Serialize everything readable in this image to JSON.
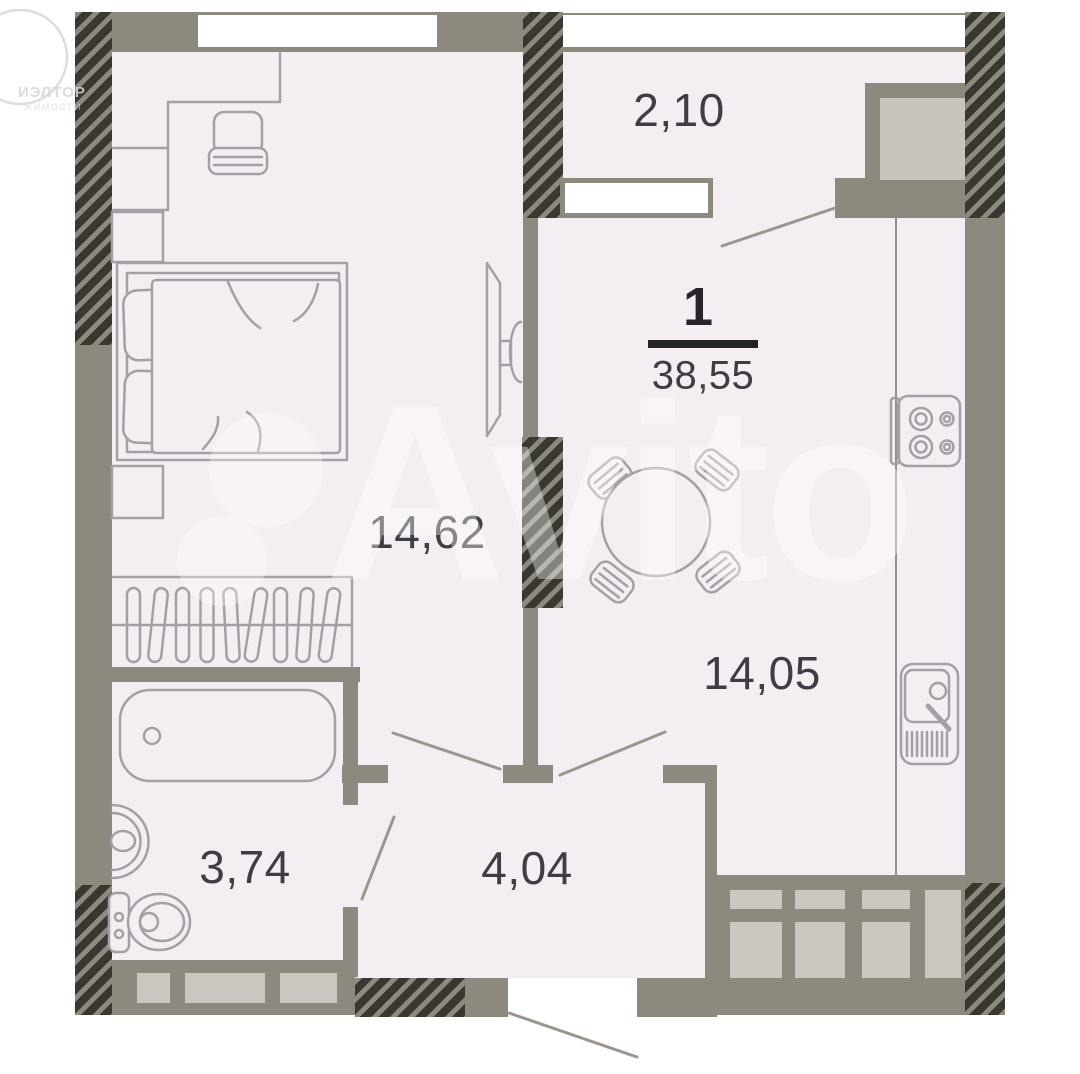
{
  "floorplan": {
    "summary": {
      "rooms_count": "1",
      "total_area": "38,55"
    },
    "rooms": [
      {
        "id": "balcony",
        "area": "2,10"
      },
      {
        "id": "bedroom",
        "area": "14,62"
      },
      {
        "id": "kitchen-living",
        "area": "14,05"
      },
      {
        "id": "bathroom",
        "area": "3,74"
      },
      {
        "id": "hallway",
        "area": "4,04"
      }
    ],
    "watermarks": {
      "portal": "Avito",
      "agency_line1": "ИЭЛТОР",
      "agency_line2": "ЖИМОСТИ"
    },
    "colors": {
      "wall": "#8d897f",
      "hatch": "#393830",
      "floor": "#f4eef3",
      "panel": "#cac7c1",
      "shaft": "#c7c4bd",
      "ink": "#3f3c45",
      "line": "#a59ea6",
      "door": "#9c958e"
    }
  }
}
